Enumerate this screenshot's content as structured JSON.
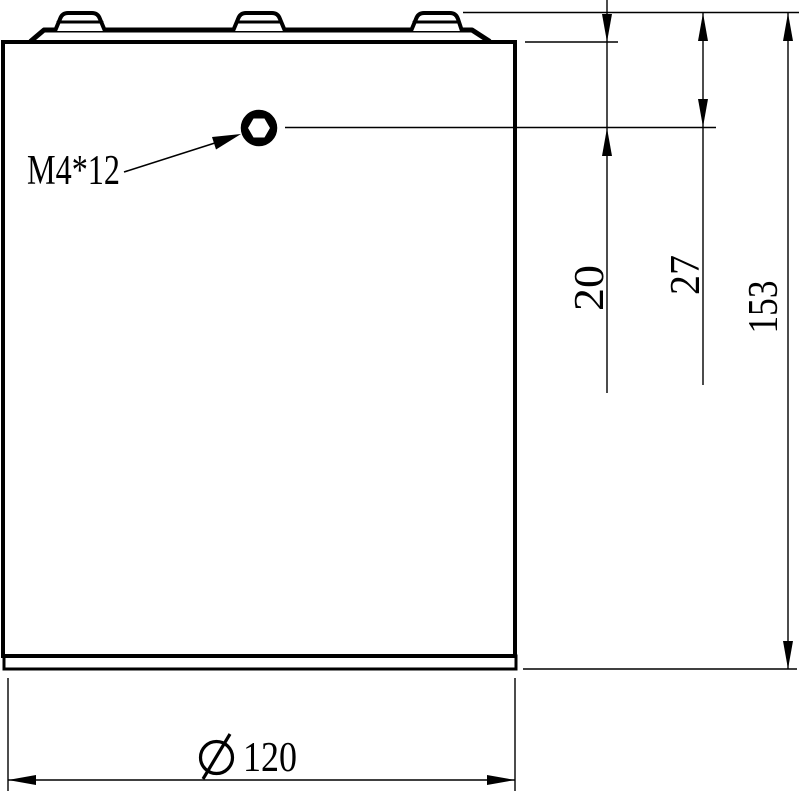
{
  "colors": {
    "ink": "#000000",
    "paper": "#ffffff"
  },
  "callout": {
    "label": "M4*12"
  },
  "dimensions": {
    "dim_20": {
      "value": "20"
    },
    "dim_27": {
      "value": "27"
    },
    "dim_153": {
      "value": "153"
    },
    "dim_diameter": {
      "symbol": "Ø",
      "value": "120"
    }
  },
  "icons": {
    "screw_head": "hex-socket-screw-top-view",
    "diameter_symbol": "slashed-circle-diameter-sign"
  }
}
